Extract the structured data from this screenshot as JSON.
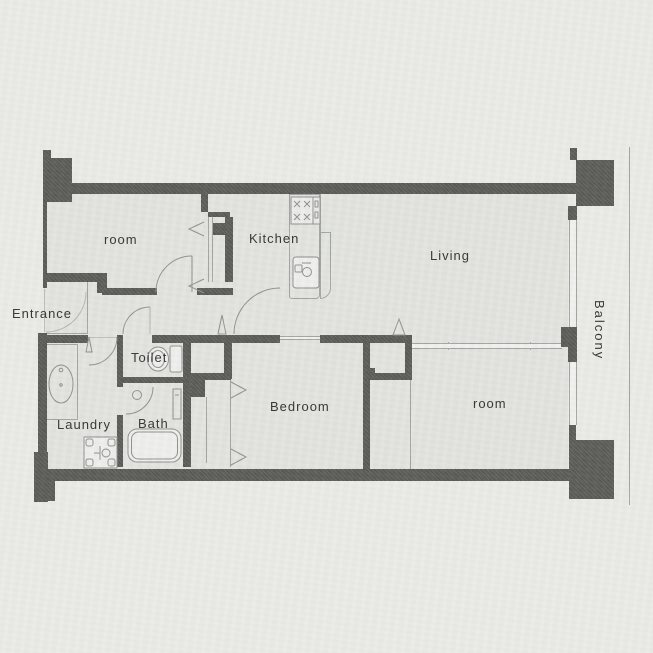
{
  "plan": {
    "type": "apartment-floor-plan",
    "labels": {
      "room_top_left": "room",
      "kitchen": "Kitchen",
      "living": "Living",
      "entrance": "Entrance",
      "toilet": "Toilet",
      "bath": "Bath",
      "laundry": "Laundry",
      "bedroom": "Bedroom",
      "room_bottom_right": "room",
      "balcony": "Balcony"
    },
    "icons": [
      "stove-icon",
      "kitchen-sink-icon",
      "toilet-icon",
      "bathtub-icon",
      "washing-machine-icon",
      "vanity-basin-icon",
      "door-swing-icon",
      "folding-door-icon"
    ],
    "colors": {
      "background": "#ebebe8",
      "floor": "#e3e3e0",
      "wall": "#5c5c59",
      "line": "#a2a5a2",
      "window_fill": "#f1f1ef",
      "text": "#343432"
    }
  }
}
